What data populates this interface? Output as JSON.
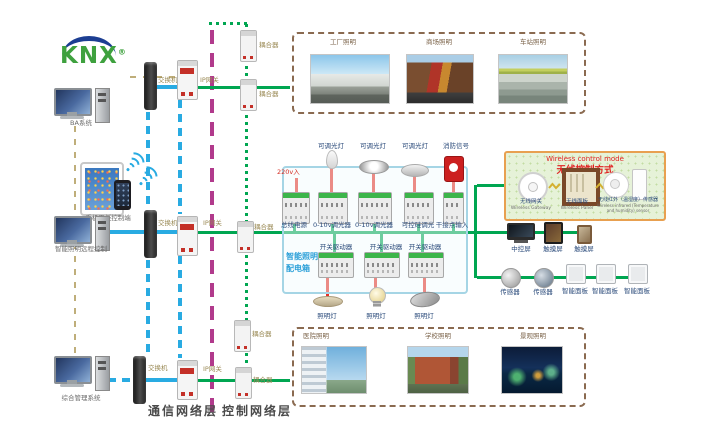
{
  "logo": {
    "text": "KNX",
    "reg": "®"
  },
  "left": {
    "pc_ba_label": "BA系统",
    "mobile_label": "手机平板控制端",
    "pc_remote_label": "智能照明远程控制",
    "pc_mgmt_label": "综合管理系统"
  },
  "net": {
    "switch_label": "交换机",
    "gateway_label": "IP网关",
    "coupler_label": "耦合器"
  },
  "layers": {
    "comm_label": "通信网络层",
    "ctrl_label": "控制网络层"
  },
  "panel": {
    "title_line1": "智能照明",
    "title_line2": "配电箱",
    "input_label": "220v入",
    "top_modules": [
      "总线电源",
      "0-10v调光器",
      "0-10v调光器",
      "可控硅调光",
      "干接点输入"
    ],
    "top_loads": [
      "可调光灯",
      "可调光灯",
      "可调光灯",
      "消防信号"
    ],
    "actuators": [
      "开关驱动器",
      "开关驱动器",
      "开关驱动器"
    ],
    "bottom_loads": [
      "照明灯",
      "照明灯",
      "照明灯"
    ]
  },
  "wireless": {
    "title_en": "Wireless control mode",
    "title_zh": "无线控制方式",
    "devices": [
      {
        "zh": "无线网关",
        "en": "Wireless Gateway"
      },
      {
        "zh": "无线面板",
        "en": "Wireless Panel"
      },
      {
        "zh": "无线红外（温湿度）传感器",
        "en": "Wireless infrared (Temperature and humidity) sensor"
      }
    ]
  },
  "right": {
    "row1": [
      "中控屏",
      "触摸屏",
      "触摸屏"
    ],
    "row2": [
      "传感器",
      "传感器",
      "智能面板",
      "智能面板",
      "智能面板"
    ]
  },
  "apps": {
    "top": [
      "工厂照明",
      "商场照明",
      "车站照明"
    ],
    "bottom": [
      "医院照明",
      "学校照明",
      "景观照明"
    ]
  },
  "colors": {
    "knx_bus_green": "#00a651",
    "comm_blue": "#29abe2",
    "backbone_purple": "#b13a8c",
    "power_red": "#e63026",
    "ba_network_tan": "#bfae7a",
    "wireless_border_orange": "#e8a050",
    "wireless_title_red": "#e02020",
    "panel_border_blue": "#a5d5e5",
    "knx_logo_green": "#3ea13e",
    "knx_logo_arc_blue": "#1c3e92"
  }
}
